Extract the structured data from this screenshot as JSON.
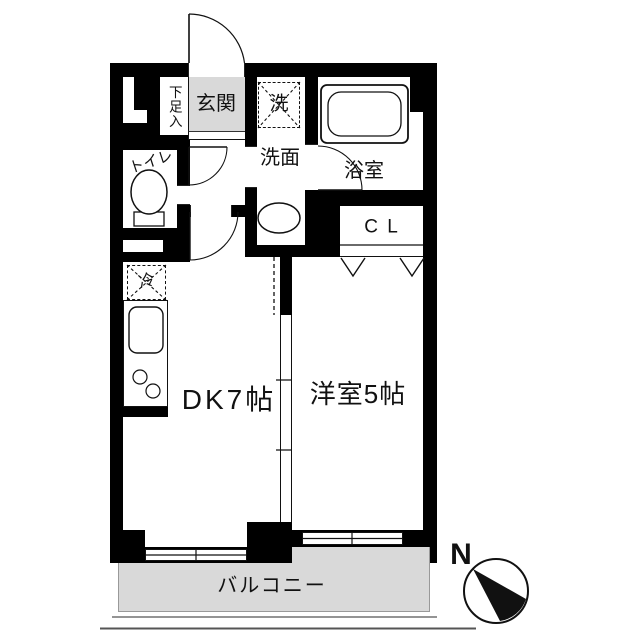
{
  "floorplan": {
    "rooms": {
      "shoe_storage": {
        "label": "下足入"
      },
      "genkan": {
        "label": "玄関"
      },
      "washer": {
        "label": "洗"
      },
      "senmen": {
        "label": "洗面"
      },
      "bath": {
        "label": "浴室"
      },
      "toilet": {
        "label": "トイレ"
      },
      "closet": {
        "label": "C L"
      },
      "fridge": {
        "label": "冷"
      },
      "dining_kitchen": {
        "label": "DK7帖"
      },
      "western_room": {
        "label": "洋室5帖"
      },
      "balcony": {
        "label": "バルコニー"
      }
    },
    "compass": {
      "label": "N"
    },
    "colors": {
      "wall": "#000000",
      "genkan_fill": "#d9d9d9",
      "balcony_fill": "#d9d9d9"
    }
  }
}
